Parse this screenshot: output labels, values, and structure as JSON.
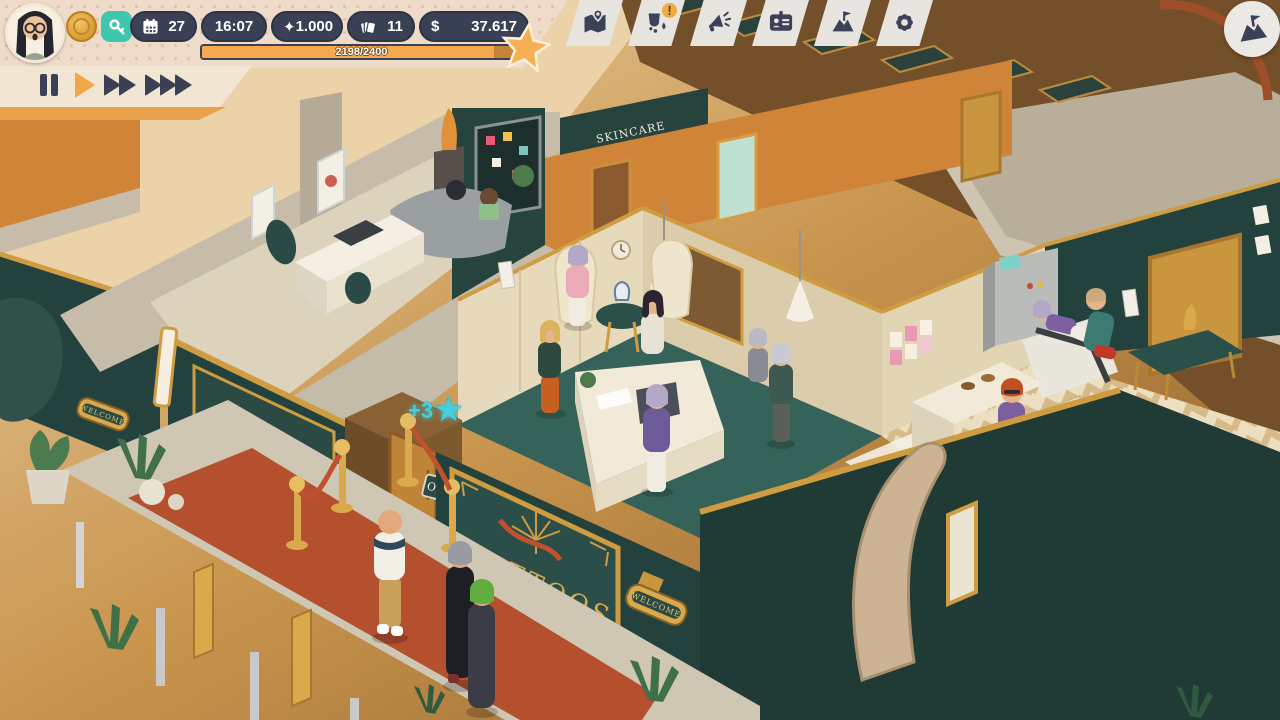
{
  "hud": {
    "player": {
      "avatar": "player-portrait-woman-glasses"
    },
    "coin_icon": "gold-coin-icon",
    "key_icon": "key-icon",
    "stats": {
      "day": {
        "icon": "calendar-icon",
        "value": "27"
      },
      "time": {
        "value": "16:07"
      },
      "beauty": {
        "icon": "sparkle-icon",
        "icon_char": "✦",
        "value": "1.000"
      },
      "tickets": {
        "icon": "cards-icon",
        "value": "11"
      },
      "money": {
        "symbol": "$",
        "value": "37.617"
      }
    },
    "xp": {
      "progress_label": "2198/2400",
      "value": 2198,
      "max": 2400,
      "percent": 91.6,
      "icon": "star-icon"
    },
    "toolbar": {
      "buttons": [
        {
          "icon": "map-icon"
        },
        {
          "icon": "cleanliness-icon",
          "badge": "!"
        },
        {
          "icon": "marketing-megaphone-icon"
        },
        {
          "icon": "staff-id-card-icon"
        },
        {
          "icon": "goals-flag-icon"
        },
        {
          "icon": "settings-gear-icon"
        }
      ],
      "milestone_icon": "milestone-mountain-flag-icon"
    },
    "speed_controls": {
      "active": "play",
      "buttons": [
        "pause",
        "play",
        "fast-forward",
        "fastest-forward"
      ]
    }
  },
  "scene": {
    "signs": {
      "shop_main": "TATTOOS",
      "shop_side": "TATTOOS",
      "open": "OPEN",
      "welcome_front": "WELCOME",
      "welcome_left": "WELCOME",
      "skincare": "SKINCARE"
    },
    "floating_reward": {
      "text": "+3",
      "icon_char": "★"
    }
  },
  "colors": {
    "hud_pill": "#3b4154",
    "hud_panel": "#eedbc9",
    "accent_orange": "#f5a94c",
    "key_teal": "#3fc7ae",
    "badge_orange": "#f2a93e",
    "reward_cyan": "#45cfdd",
    "wall_teal": "#24423d",
    "wall_cream": "#e7dabc",
    "wall_orange": "#d08438",
    "floor_teal": "#35635a",
    "carpet_red": "#b5502e",
    "gold": "#cf9c42"
  }
}
